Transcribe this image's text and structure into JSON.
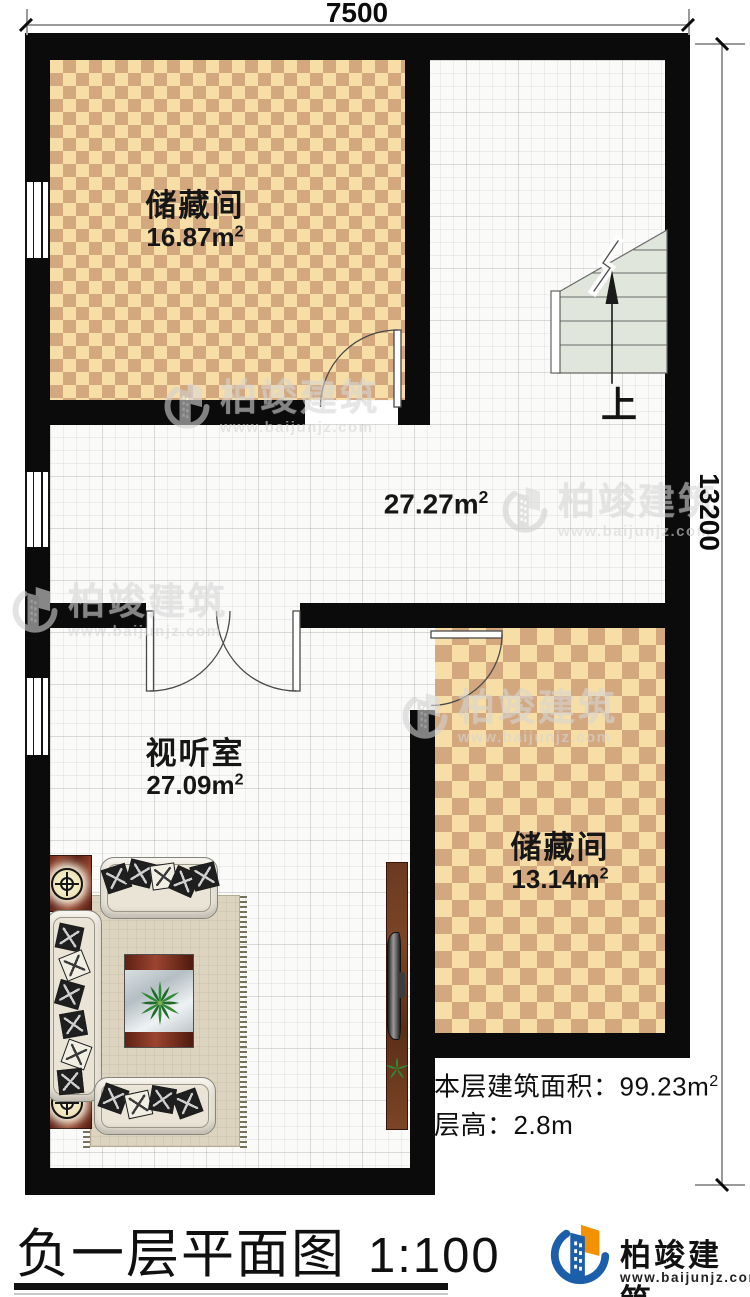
{
  "dimensions": {
    "width": "7500",
    "height": "13200"
  },
  "rooms": {
    "storage_top": {
      "name": "储藏间",
      "area": "16.87m",
      "sup": "2"
    },
    "hall": {
      "area": "27.27m",
      "sup": "2"
    },
    "av": {
      "name": "视听室",
      "area": "27.09m",
      "sup": "2"
    },
    "storage_right": {
      "name": "储藏间",
      "area": "13.14m",
      "sup": "2"
    }
  },
  "stairs": {
    "up_label": "上"
  },
  "info": {
    "area_label": "本层建筑面积：",
    "area_value": "99.23m",
    "area_sup": "2",
    "floor_height": "层高：2.8m"
  },
  "title": {
    "main": "负一层平面图",
    "scale": "1:100"
  },
  "brand": {
    "name": "柏竣建筑",
    "url": "www.baijunjz.com"
  },
  "watermark": {
    "name": "柏竣建筑",
    "url": "www.baijunjz.com"
  },
  "colors": {
    "wall": "#0b0b0b",
    "checker_light": "#f6dea6",
    "checker_dark": "#d3a87f",
    "stair_fill": "#e0e6dc",
    "brand_blue": "#1b5ea9",
    "brand_orange": "#f29200"
  }
}
